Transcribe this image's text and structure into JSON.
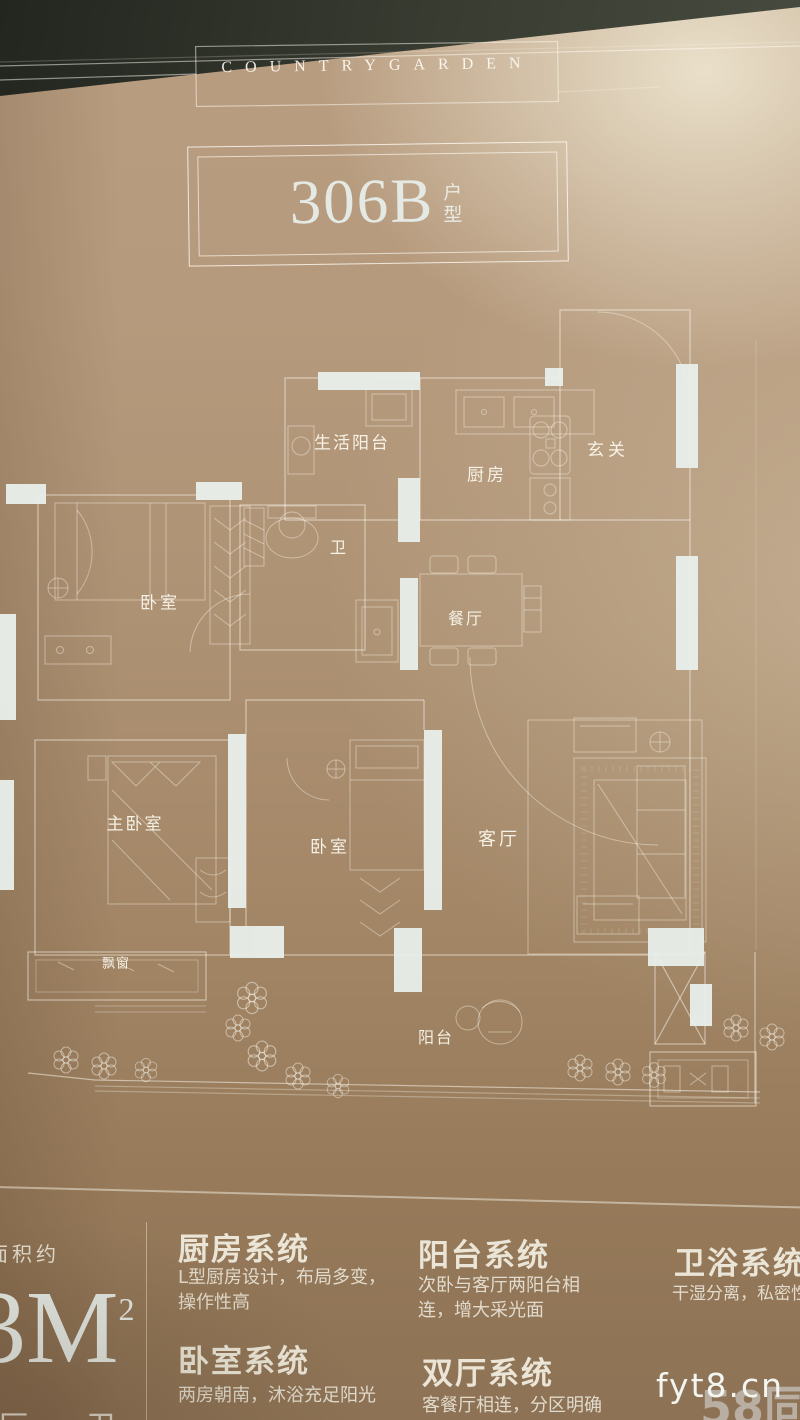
{
  "brand_banner": "COUNTRYGARDEN",
  "unit_title": {
    "code": "306B",
    "suffix": "户型"
  },
  "floor_plan": {
    "rooms": [
      {
        "id": "service-balcony",
        "label": "生活阳台"
      },
      {
        "id": "kitchen",
        "label": "厨房"
      },
      {
        "id": "foyer",
        "label": "玄关"
      },
      {
        "id": "bath",
        "label": "卫"
      },
      {
        "id": "bedroom-north",
        "label": "卧室"
      },
      {
        "id": "dining",
        "label": "餐厅"
      },
      {
        "id": "master-bedroom",
        "label": "主卧室"
      },
      {
        "id": "bedroom-middle",
        "label": "卧室"
      },
      {
        "id": "living-room",
        "label": "客厅"
      },
      {
        "id": "bay-window",
        "label": "飘窗"
      },
      {
        "id": "balcony",
        "label": "阳台"
      }
    ]
  },
  "area_panel": {
    "prefix": "面积约",
    "value": "3M",
    "sup": "2",
    "rooms_cutoff": "厅一卫"
  },
  "systems": [
    {
      "title": "厨房系统",
      "desc": "L型厨房设计，布局多变，\n操作性高"
    },
    {
      "title": "阳台系统",
      "desc": "次卧与客厅两阳台相\n连，增大采光面"
    },
    {
      "title": "卫浴系统",
      "desc": "干湿分离，私密性"
    },
    {
      "title": "卧室系统",
      "desc": "两房朝南，沐浴充足阳光"
    },
    {
      "title": "双厅系统",
      "desc": "客餐厅相连，分区明确"
    }
  ],
  "watermarks": {
    "site": "fyt8.cn",
    "portal": "58同城"
  },
  "colors": {
    "page_light": "#d9ccb3",
    "page_dark": "#8d7255",
    "line_white": "#f4f1e6",
    "wall_white": "#e9efeb"
  }
}
